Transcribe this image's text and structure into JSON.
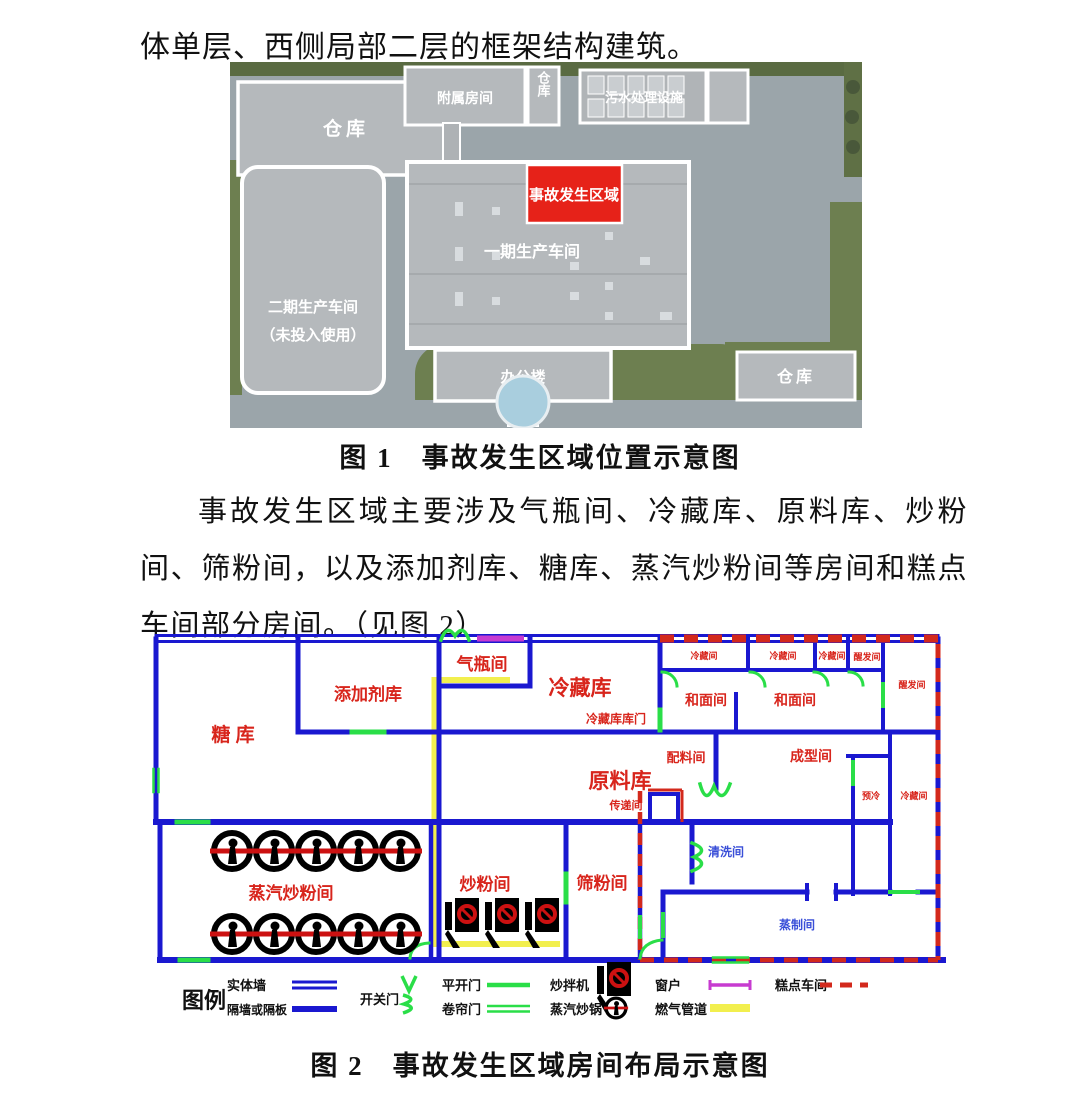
{
  "page": {
    "intro_text": "体单层、西侧局部二层的框架结构建筑。",
    "paragraph": "事故发生区域主要涉及气瓶间、冷藏库、原料库、炒粉间、筛粉间，以及添加剂库、糖库、蒸汽炒粉间等房间和糕点车间部分房间。（见图 2）",
    "figure1_caption": "图 1　事故发生区域位置示意图",
    "figure2_caption": "图 2　事故发生区域房间布局示意图"
  },
  "site_map": {
    "labels": {
      "warehouse_tl": "仓库",
      "annex": "附属房间",
      "warehouse_top": "仓库",
      "sewage": "污水处理设施",
      "phase2_line1": "二期生产车间",
      "phase2_line2": "（未投入使用）",
      "accident_area": "事故发生区域",
      "phase1": "一期生产车间",
      "office": "办公楼",
      "warehouse_br": "仓库"
    },
    "colors": {
      "accident_red": "#e62219",
      "grass": "#6d7f50",
      "ground": "#9ba5aa",
      "building": "#b5b9bc"
    }
  },
  "floor_plan": {
    "rooms": {
      "qipingjian": "气瓶间",
      "tianjiajiku": "添加剂库",
      "lengcangku": "冷藏库",
      "tangku": "糖 库",
      "yuanliaoku": "原料库",
      "lengcangkukumen": "冷藏库库门",
      "peiliaojian": "配料间",
      "chuandijian": "传递间",
      "hemianjian1": "和面间",
      "hemianjian2": "和面间",
      "lengcangjian1": "冷藏间",
      "lengcangjian2": "冷藏间",
      "lengcangjian3": "冷藏间",
      "xingfajian1": "醒发间",
      "xingfajian2": "醒发间",
      "chengxingjian": "成型间",
      "yuleng": "预冷",
      "lengcangjian4": "冷藏间",
      "zhengqichaofenjian": "蒸汽炒粉间",
      "chaofenjian": "炒粉间",
      "shaifenjian": "筛粉间",
      "qingxijian": "清洗间",
      "zhengzhijian": "蒸制间"
    },
    "legend": {
      "title": "图例",
      "solid_wall": "实体墙",
      "partition_wall": "隔墙或隔板",
      "switch_door": "开关门",
      "swing_door": "平开门",
      "roller_door": "卷帘门",
      "fry_mixer": "炒拌机",
      "steam_fry_pot": "蒸汽炒锅",
      "window": "窗户",
      "gas_pipe": "燃气管道",
      "pastry_workshop": "糕点车间"
    },
    "colors": {
      "wall": "#1a18d0",
      "door": "#2ade48",
      "window": "#c73bc9",
      "gas_pipe": "#f2ef4e",
      "pastry_boundary": "#d3291c",
      "label_red": "#d8251c",
      "label_blue": "#3a4fd8"
    }
  }
}
